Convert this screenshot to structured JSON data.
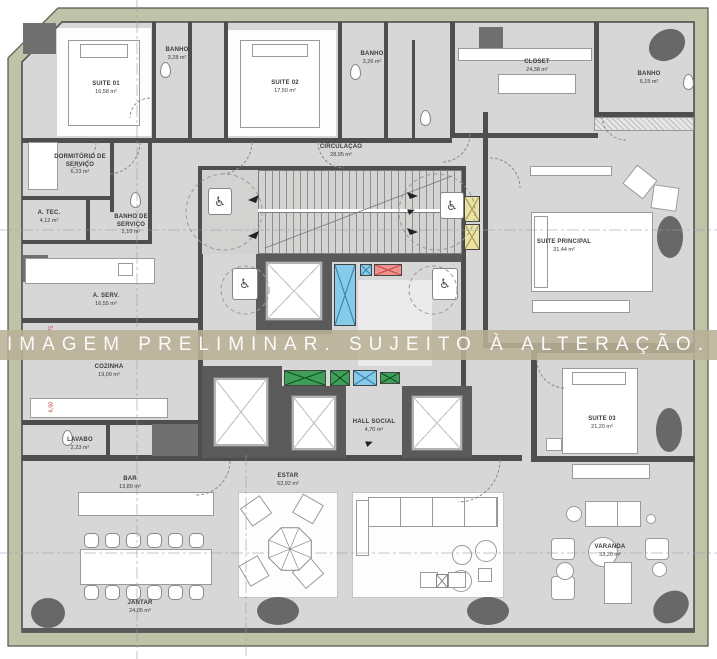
{
  "watermark": {
    "text": "IMAGEM PRELIMINAR. SUJEITO À ALTERAÇÃO."
  },
  "rooms": {
    "suite01": {
      "name": "SUITE 01",
      "area": "16,58 m²"
    },
    "banho1": {
      "name": "BANHO",
      "area": "3,28 m²"
    },
    "suite02": {
      "name": "SUITE 02",
      "area": "17,50 m²"
    },
    "banho2": {
      "name": "BANHO",
      "area": "3,26 m²"
    },
    "closet": {
      "name": "CLOSET",
      "area": "24,38 m²"
    },
    "banho_master": {
      "name": "BANHO",
      "area": "6,15 m²"
    },
    "suite_principal": {
      "name": "SUITE PRINCIPAL",
      "area": "31,44 m²"
    },
    "circulacao": {
      "name": "CIRCULAÇÃO",
      "area": "28,95 m²"
    },
    "dormitorio_servico": {
      "name": "DORMITÓRIO DE SERVIÇO",
      "area": "6,23 m²"
    },
    "banho_servico": {
      "name": "BANHO DE SERVIÇO",
      "area": "2,10 m²"
    },
    "a_tec": {
      "name": "A. TEC.",
      "area": "4,12 m²"
    },
    "a_serv": {
      "name": "A. SERV.",
      "area": "16,55 m²"
    },
    "cozinha": {
      "name": "COZINHA",
      "area": "19,09 m²"
    },
    "lavabo": {
      "name": "LAVABO",
      "area": "2,23 m²"
    },
    "hall_social": {
      "name": "HALL SOCIAL",
      "area": "4,70 m²"
    },
    "suite03": {
      "name": "SUITE 03",
      "area": "21,20 m²"
    },
    "bar": {
      "name": "BAR",
      "area": "13,89 m²"
    },
    "estar": {
      "name": "ESTAR",
      "area": "62,92 m²"
    },
    "jantar": {
      "name": "JANTAR",
      "area": "24,05 m²"
    },
    "varanda": {
      "name": "VARANDA",
      "area": "33,20 m²"
    }
  },
  "dimensions": {
    "d1": "0,75",
    "d2": "6,50"
  },
  "icons": {
    "wheelchair": "♿"
  },
  "colors": {
    "facade_band": "#bfc4a8",
    "floor": "#d7d7d7",
    "wall": "#4e4e4e",
    "shaft_blue": "#85cbe9",
    "shaft_red": "#f2928e",
    "shaft_green": "#3f9e57",
    "shaft_yellow": "#eae3a4",
    "watermark_band": "#b9b196",
    "plant": "#686868"
  }
}
